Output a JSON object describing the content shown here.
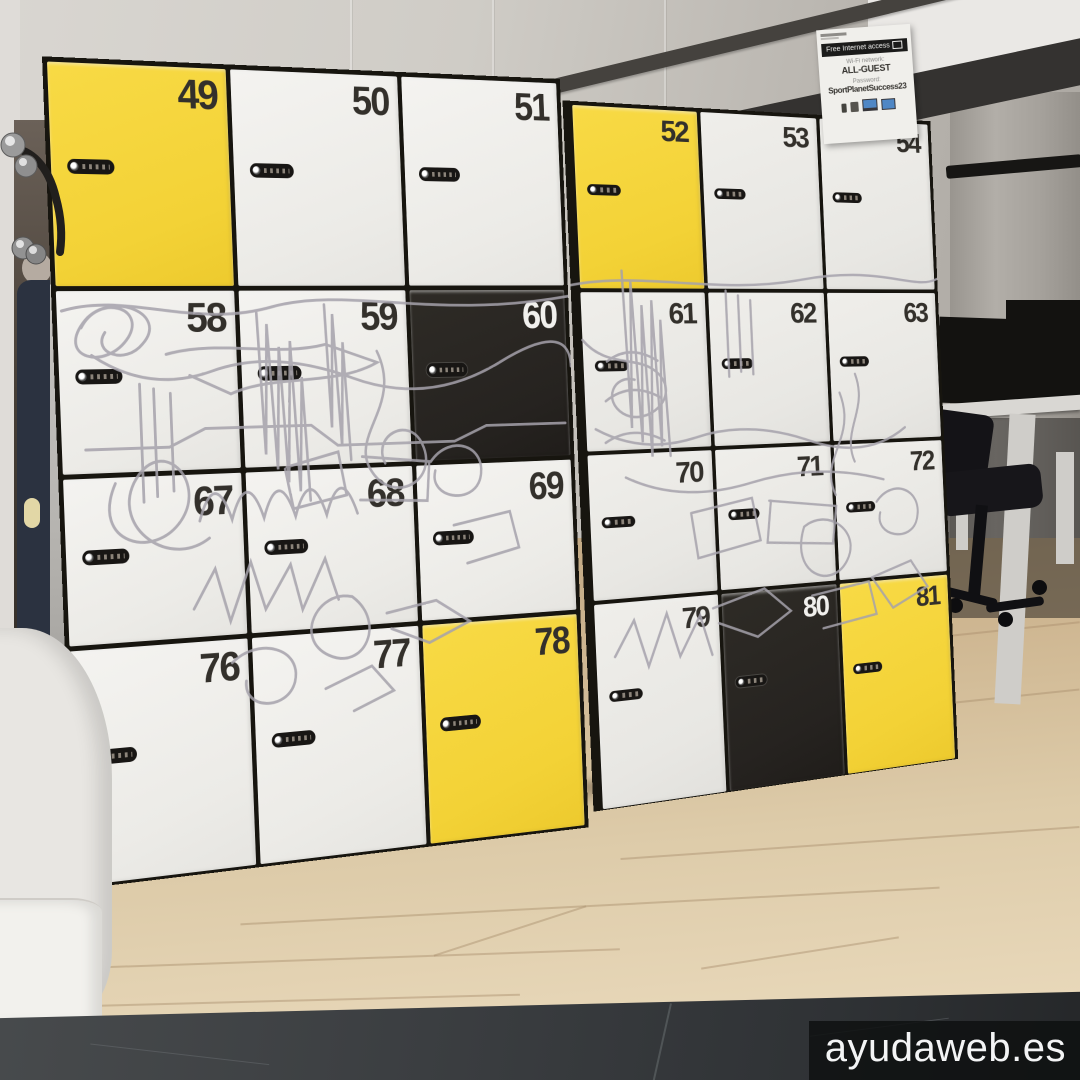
{
  "scene": {
    "watermark": "ayudaweb.es",
    "wifi_sign": {
      "banner": "Free Internet access",
      "network_label": "Wi-Fi network:",
      "network_name": "ALL-GUEST",
      "password_label": "Password:",
      "password": "SportPlanetSuccess23"
    },
    "lockers": {
      "left_cabinet_rows": [
        [
          "49",
          "50",
          "51"
        ],
        [
          "58",
          "59",
          "60"
        ],
        [
          "67",
          "68",
          "69"
        ],
        [
          "76",
          "77",
          "78"
        ]
      ],
      "right_cabinet_rows": [
        [
          "52",
          "53",
          "54"
        ],
        [
          "61",
          "62",
          "63"
        ],
        [
          "70",
          "71",
          "72"
        ],
        [
          "79",
          "80",
          "81"
        ]
      ],
      "yellow_doors": [
        "49",
        "52",
        "78",
        "81"
      ],
      "dark_doors": [
        "60",
        "80"
      ]
    },
    "colors": {
      "door_white": "#f1f0ed",
      "door_yellow": "#f5d53a",
      "door_dark": "#29261f",
      "number_dark": "#33302b",
      "number_light": "#f1f0ed",
      "mural_line": "#a5a1ab",
      "frame": "#17150f"
    }
  }
}
